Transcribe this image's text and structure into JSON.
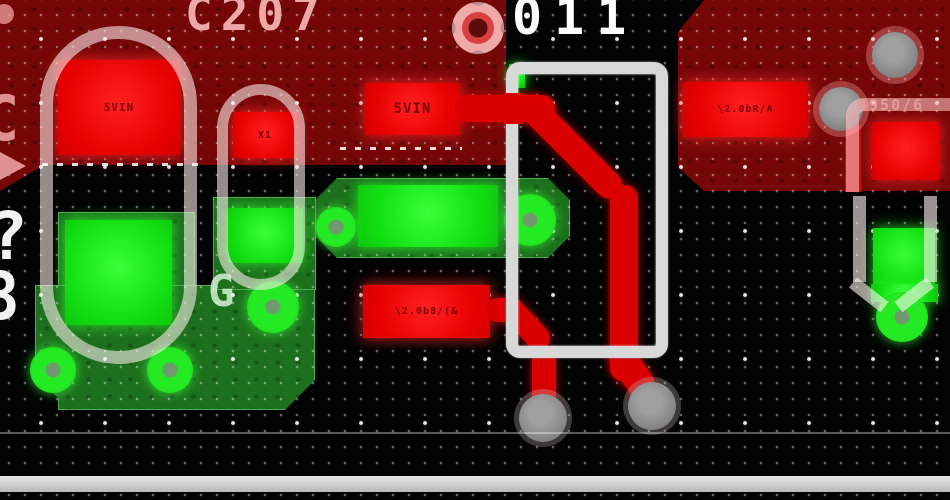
{
  "view": {
    "type": "pcb-layout-canvas",
    "grid": {
      "minor_spacing_px": 16,
      "major_spacing_px": 64,
      "style": "dots"
    }
  },
  "silkscreen_texts": {
    "ref_c207": "C207",
    "ref_011": "011",
    "ref_4950": "4950/6",
    "glyph_g": "G",
    "glyph_c": "C",
    "glyph_q": "?",
    "glyph_8": "8"
  },
  "pad_labels": {
    "left_square_net": "5VIN",
    "x1_net": "X1",
    "top_rect_net": "5VIN",
    "mid_rect_net": "\\2.0b8/(&",
    "right_rect_net": "\\2.0bR/A"
  },
  "layers": {
    "top_copper_color": "#d90000",
    "top_pour_color": "#760707",
    "bottom_copper_color": "#12e012",
    "bottom_pour_color": "#1d701d",
    "silkscreen_color": "#d8d8d8",
    "via_color": "#838383",
    "background_color": "#030303",
    "grid_dot_color": "#ffffff"
  },
  "object_counts": {
    "vias": 4,
    "round_pads": 6,
    "red_rect_pads": 6,
    "green_rect_pads": 4
  }
}
